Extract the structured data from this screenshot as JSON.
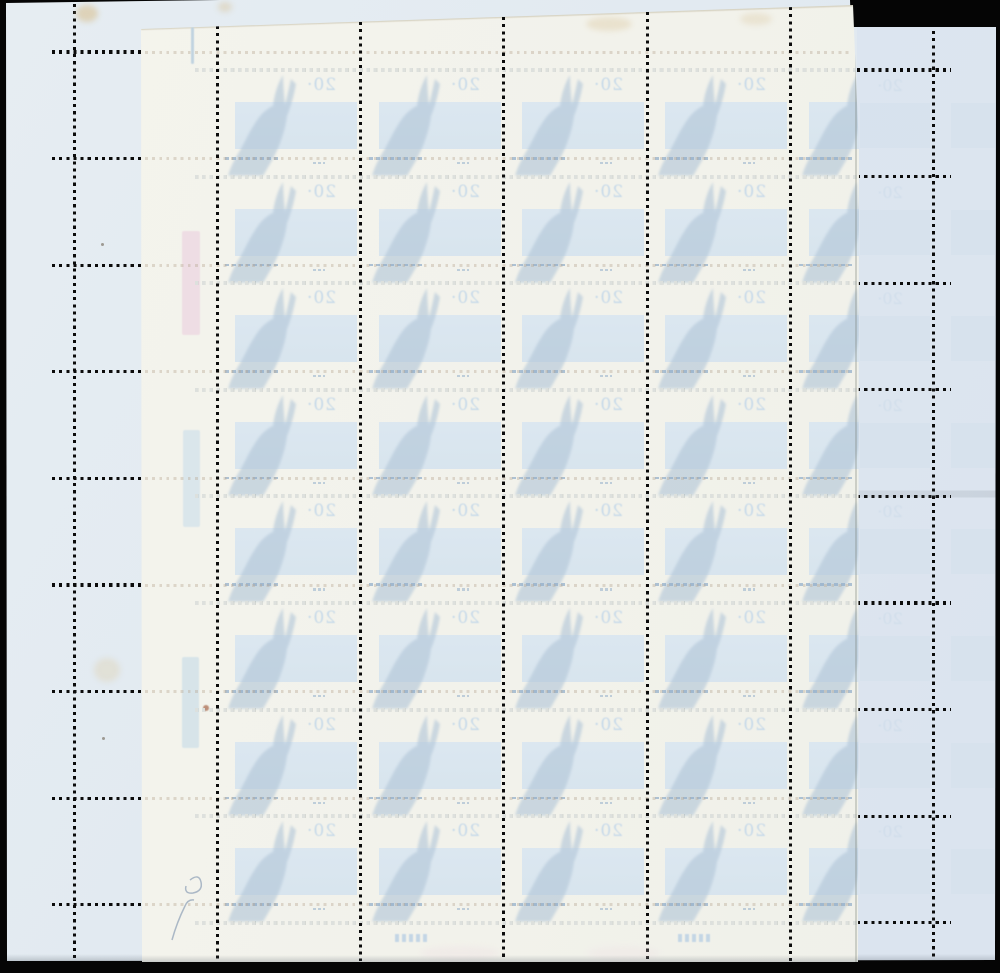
{
  "scene": {
    "kind": "scan of two overlapping postage stamp sheets, reverse side",
    "background": "#050505"
  },
  "bottom_sheet": {
    "label": "blue sheet",
    "paper_color": "#e2eaf1",
    "right_strip_tint": "#d8e2ee"
  },
  "top_sheet": {
    "label": "cream sheet",
    "paper_color": "#f3f3ec"
  },
  "stamp": {
    "denomination": "20·",
    "subject": "rabbit-silhouette",
    "mirrored": true,
    "rows": 8,
    "columns": 5,
    "band_color": "#d9e6f1",
    "silhouette_color": "#b2c6d8",
    "denomination_color": "#c6d9e9"
  },
  "perforation": {
    "dot_color": "#0b0b0b",
    "pitch": 7.15,
    "vertical_lines_x": [
      74,
      217.3,
      360.6,
      503.9,
      647.2,
      790.5,
      933.8
    ],
    "bottom_sheet_rows_y": [
      52,
      158.6,
      265.2,
      371.8,
      478.4,
      585,
      691.6,
      798.2,
      904.8
    ],
    "top_sheet_rows_y": [
      70,
      176.6,
      283.2,
      389.8,
      496.4,
      603,
      709.6,
      816.2,
      922.8
    ],
    "left_stub_x": [
      52,
      142
    ],
    "right_stub_x": [
      857,
      951
    ]
  },
  "margin_marks": {
    "color_bars": [
      {
        "x": 182,
        "y": 231,
        "w": 18,
        "h": 104,
        "color": "#eedae3",
        "opacity": 0.85
      },
      {
        "x": 183,
        "y": 430,
        "w": 17,
        "h": 97,
        "color": "#d8e5eb",
        "opacity": 0.9
      },
      {
        "x": 182,
        "y": 657,
        "w": 17,
        "h": 91,
        "color": "#d5e3e9",
        "opacity": 0.9
      }
    ],
    "register_dash": {
      "x": 191,
      "y": 27,
      "w": 3,
      "h": 37,
      "color": "#b9cfdf"
    },
    "rust_dot": {
      "x": 203,
      "y": 705,
      "w": 6,
      "h": 6,
      "color": "#b0765c"
    }
  },
  "stains": [
    {
      "x": 76,
      "y": 5,
      "w": 22,
      "h": 17,
      "color": "#d8c193",
      "opacity": 0.6
    },
    {
      "x": 94,
      "y": 658,
      "w": 26,
      "h": 24,
      "color": "#ddcda6",
      "opacity": 0.35
    },
    {
      "x": 586,
      "y": 17,
      "w": 46,
      "h": 14,
      "color": "#dcc9a2",
      "opacity": 0.4
    },
    {
      "x": 740,
      "y": 13,
      "w": 32,
      "h": 12,
      "color": "#dccaa4",
      "opacity": 0.35
    },
    {
      "x": 218,
      "y": 2,
      "w": 14,
      "h": 10,
      "color": "#d8c49b",
      "opacity": 0.45
    }
  ],
  "specks": [
    {
      "x": 101,
      "y": 243
    },
    {
      "x": 102,
      "y": 737
    },
    {
      "x": 149,
      "y": 86
    }
  ],
  "pencil_annotation": {
    "color": "#93a5ba"
  },
  "imprint_marks": [
    {
      "x": 395,
      "y": 934
    },
    {
      "x": 678,
      "y": 934
    }
  ],
  "smudges": [
    {
      "x": 420,
      "y": 946,
      "w": 80,
      "h": 14,
      "color": "#eddce2",
      "opacity": 0.3
    },
    {
      "x": 588,
      "y": 946,
      "w": 72,
      "h": 14,
      "color": "#eddce2",
      "opacity": 0.25
    }
  ]
}
